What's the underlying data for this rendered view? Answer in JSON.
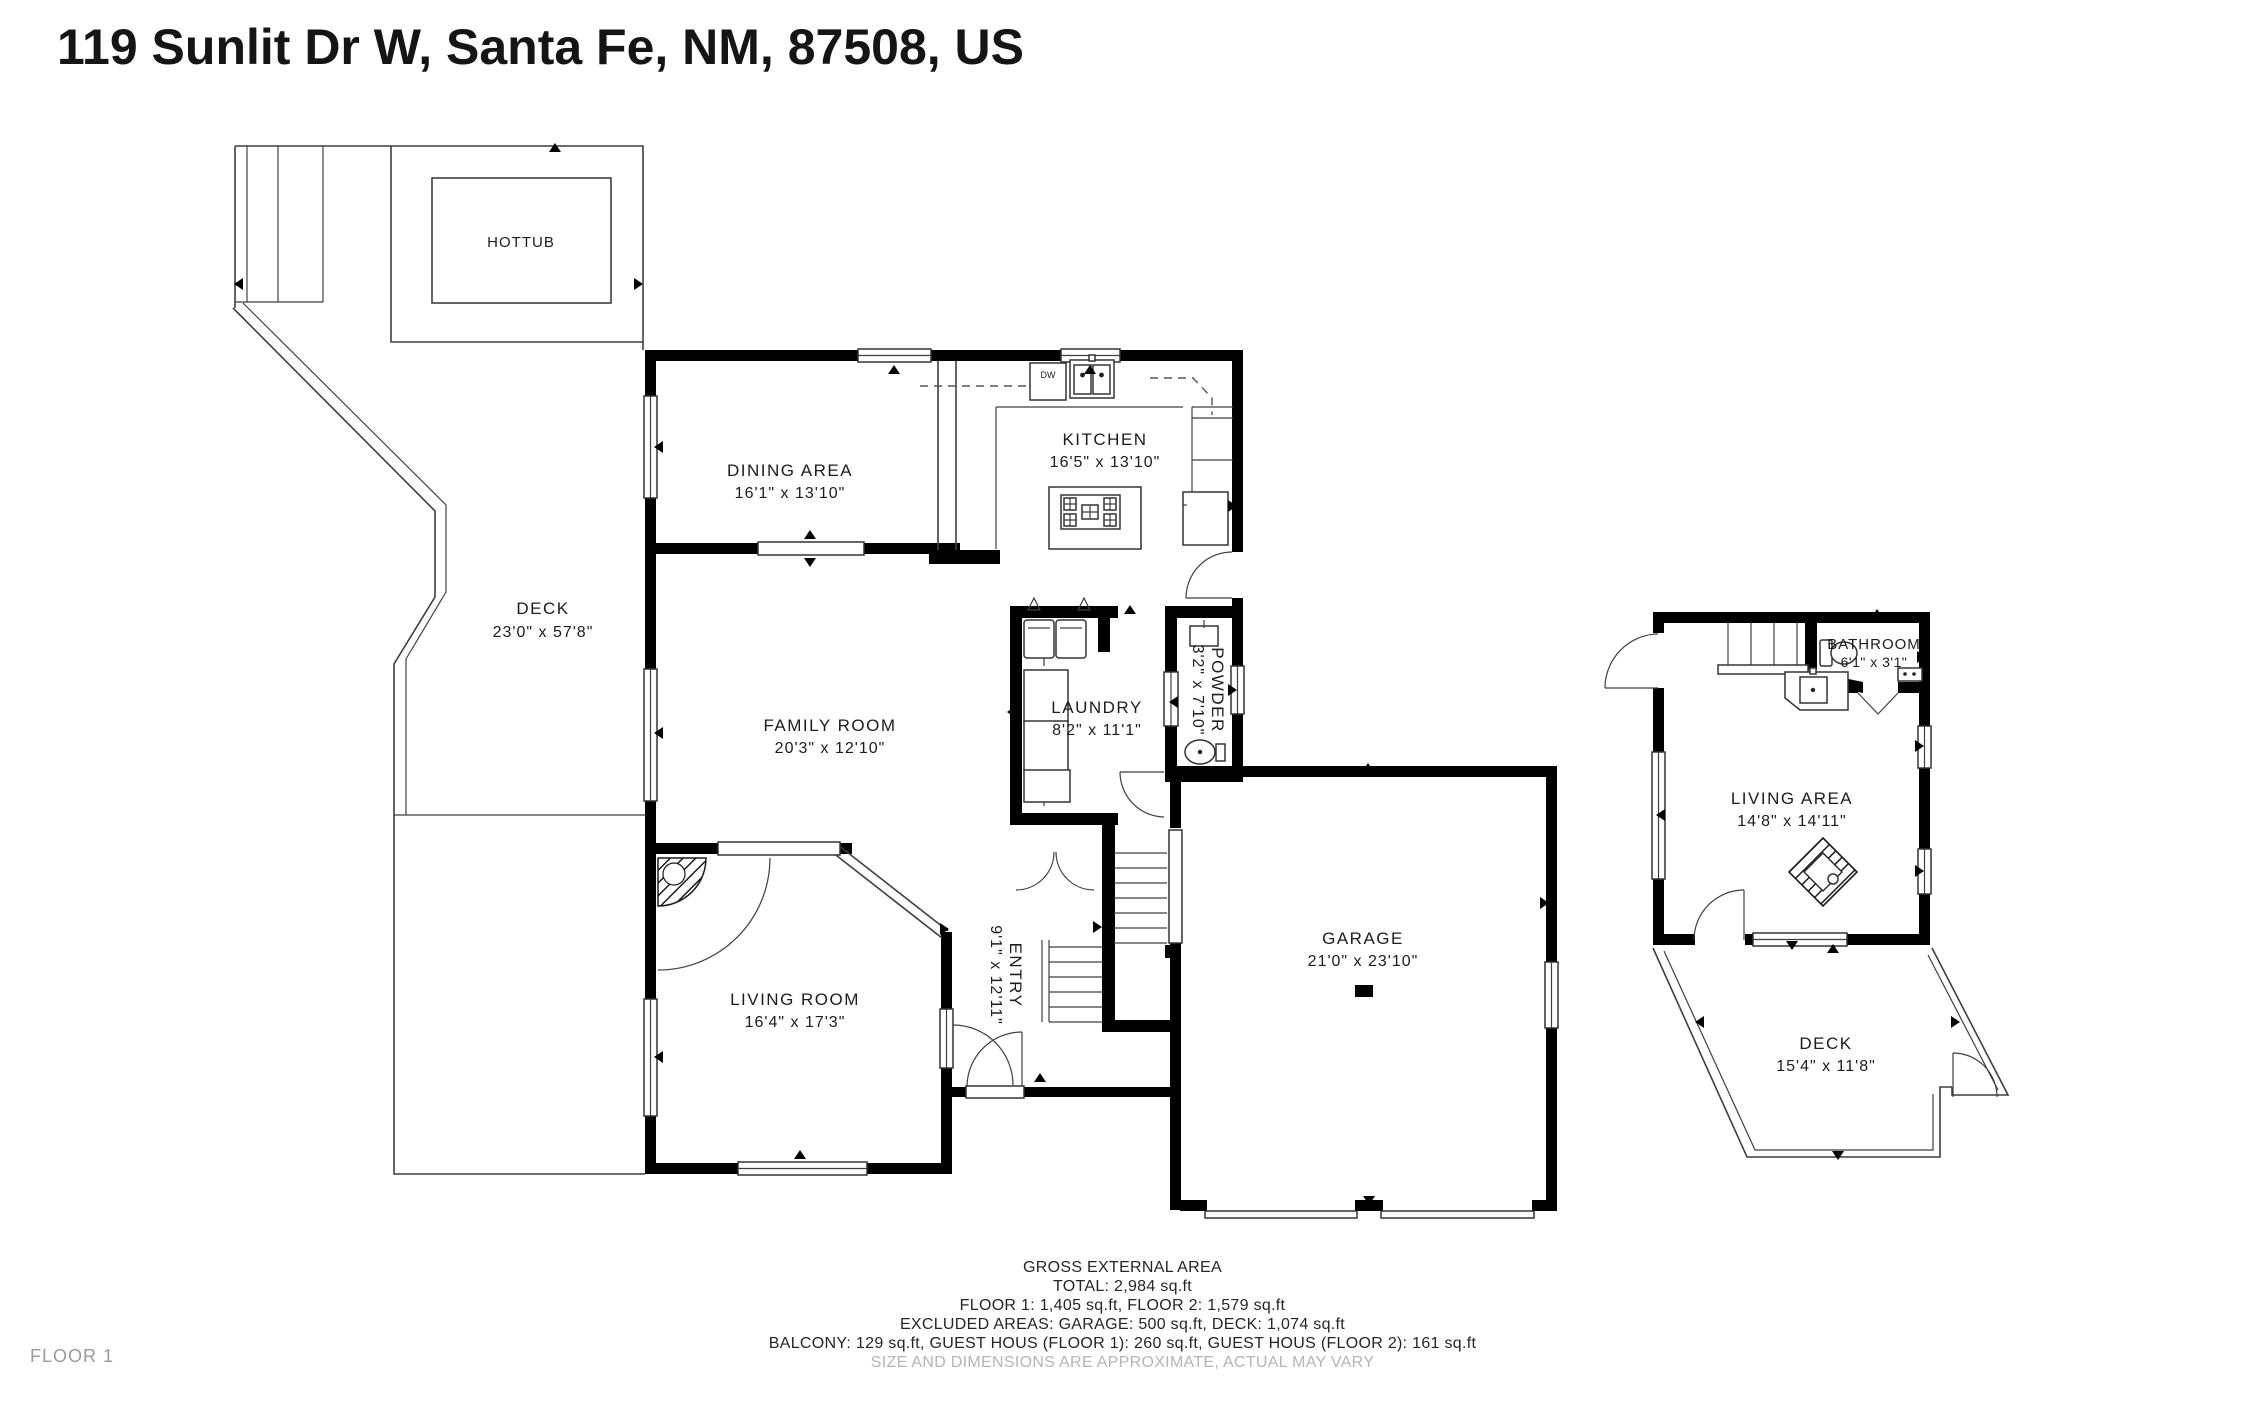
{
  "title": "119 Sunlit Dr W, Santa Fe, NM, 87508, US",
  "floor_label": "FLOOR 1",
  "colors": {
    "wall": "#000000",
    "thin_line": "#3f3f3f",
    "text": "#1c1c1c",
    "muted_text": "#9b9b9b",
    "background": "#ffffff"
  },
  "rooms": [
    {
      "name": "DINING AREA",
      "dims": "16'1\" x 13'10\""
    },
    {
      "name": "KITCHEN",
      "dims": "16'5\" x 13'10\""
    },
    {
      "name": "FAMILY ROOM",
      "dims": "20'3\" x 12'10\""
    },
    {
      "name": "LAUNDRY",
      "dims": "8'2\" x 11'1\""
    },
    {
      "name": "POWDER",
      "dims": "3'2\" x 7'10\""
    },
    {
      "name": "LIVING ROOM",
      "dims": "16'4\" x 17'3\""
    },
    {
      "name": "ENTRY",
      "dims": "9'1\" x 12'11\""
    },
    {
      "name": "GARAGE",
      "dims": "21'0\" x 23'10\""
    },
    {
      "name": "DECK",
      "dims": "23'0\" x 57'8\""
    },
    {
      "name": "LIVING AREA",
      "dims": "14'8\" x 14'11\""
    },
    {
      "name": "BATHROOM",
      "dims": "6'1\" x 3'1\""
    },
    {
      "name": "DECK",
      "dims": "15'4\" x 11'8\""
    }
  ],
  "fixtures": {
    "hottub": "HOTTUB",
    "dishwasher": "DW"
  },
  "summary": {
    "heading": "GROSS EXTERNAL AREA",
    "total": "TOTAL: 2,984 sq.ft",
    "floors": "FLOOR 1: 1,405 sq.ft, FLOOR 2: 1,579 sq.ft",
    "excluded": "EXCLUDED AREAS: GARAGE: 500 sq.ft, DECK: 1,074 sq.ft",
    "other": "BALCONY: 129 sq.ft, GUEST HOUS (FLOOR 1): 260 sq.ft, GUEST HOUS (FLOOR 2): 161 sq.ft",
    "disclaimer": "SIZE AND DIMENSIONS ARE APPROXIMATE, ACTUAL MAY VARY"
  }
}
